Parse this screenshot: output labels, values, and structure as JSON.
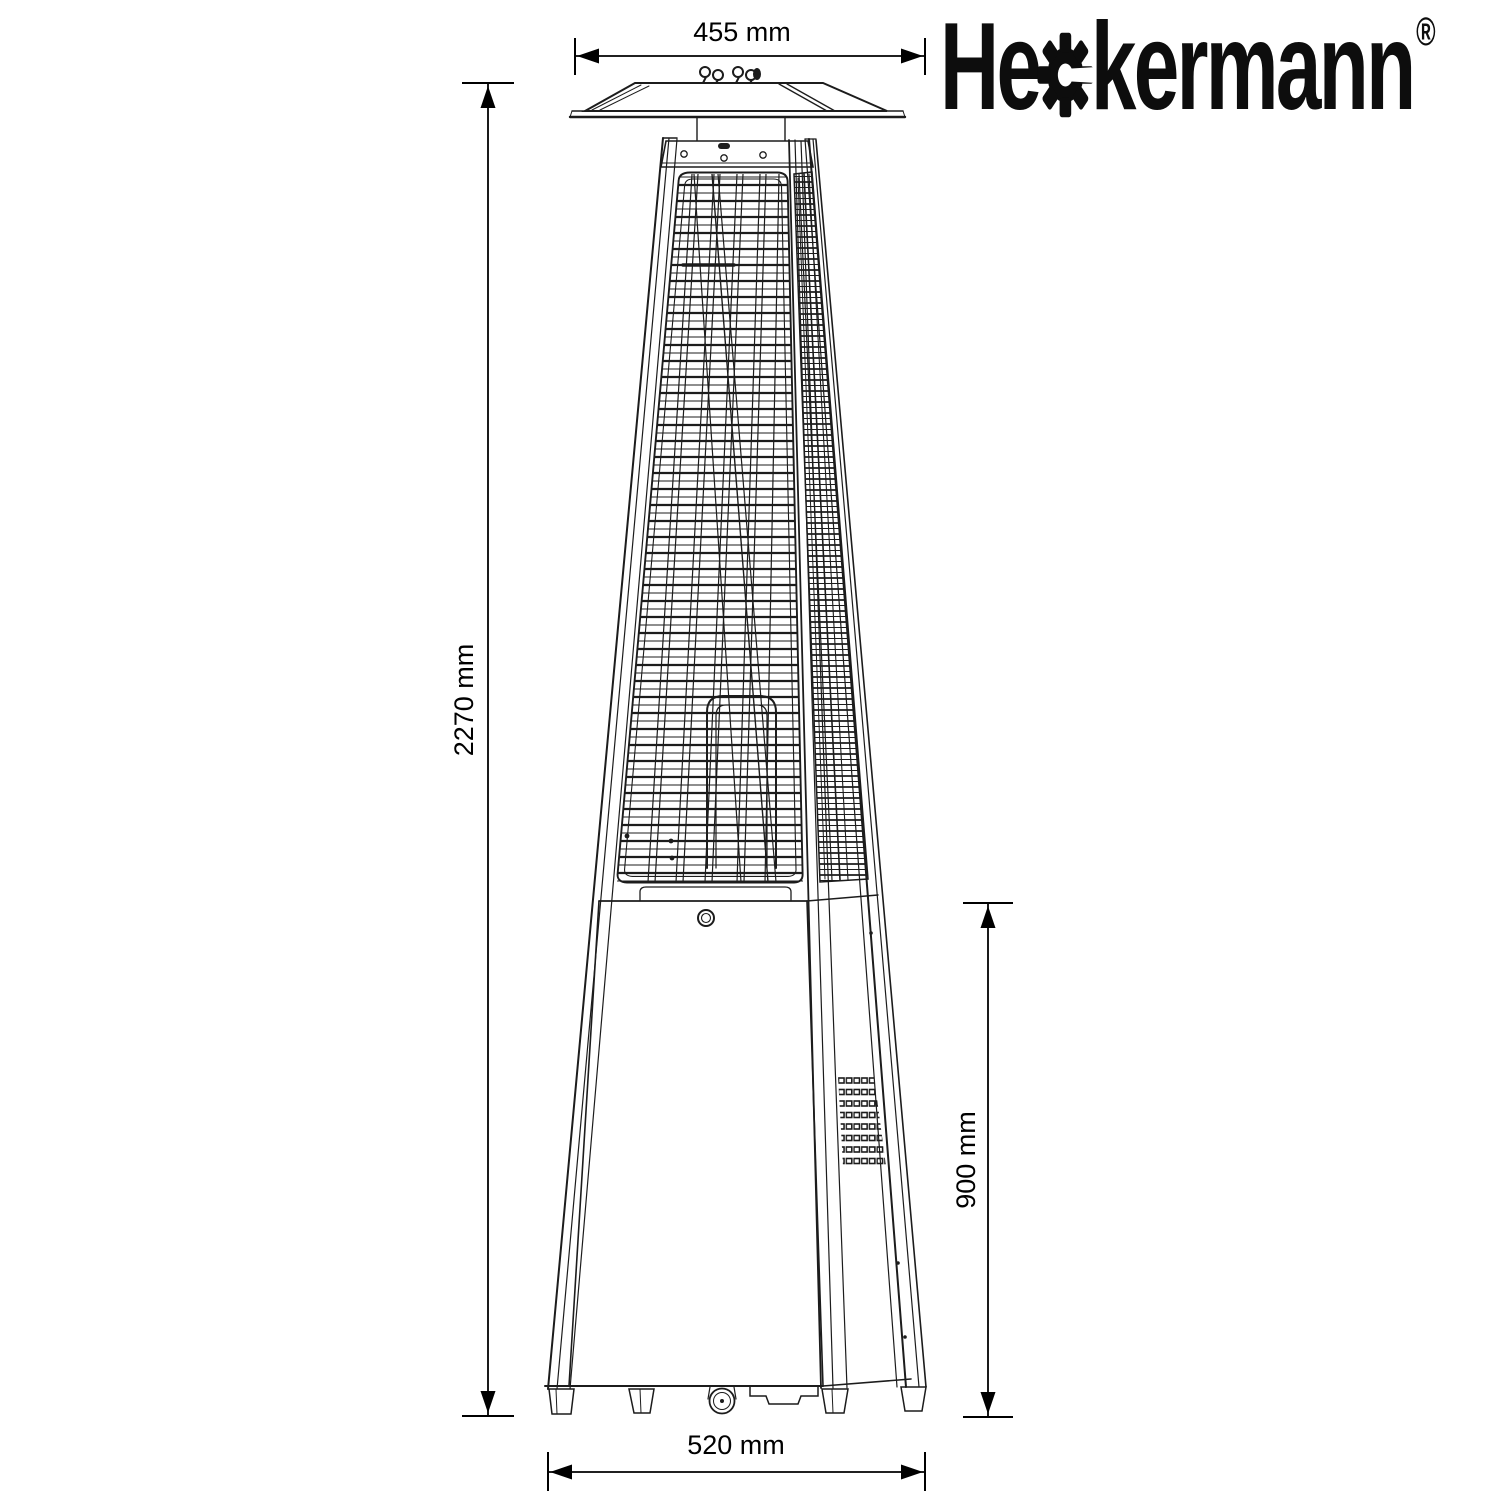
{
  "brand": {
    "name": "Heckermann",
    "logo_prefix": "He",
    "logo_suffix": "kermann",
    "registered_mark": "®"
  },
  "dimensions": {
    "reflector_width": "455 mm",
    "total_height": "2270 mm",
    "lower_section_height": "900 mm",
    "base_width": "520 mm"
  },
  "icons": {
    "logo_gear": "gear-icon"
  },
  "colors": {
    "background": "#ffffff",
    "line": "#1c1c1c",
    "dimension_text": "#000000",
    "logo": "#0d0d0d"
  },
  "drawing_subject": "pyramid flame patio heater - dimensioned technical line drawing"
}
